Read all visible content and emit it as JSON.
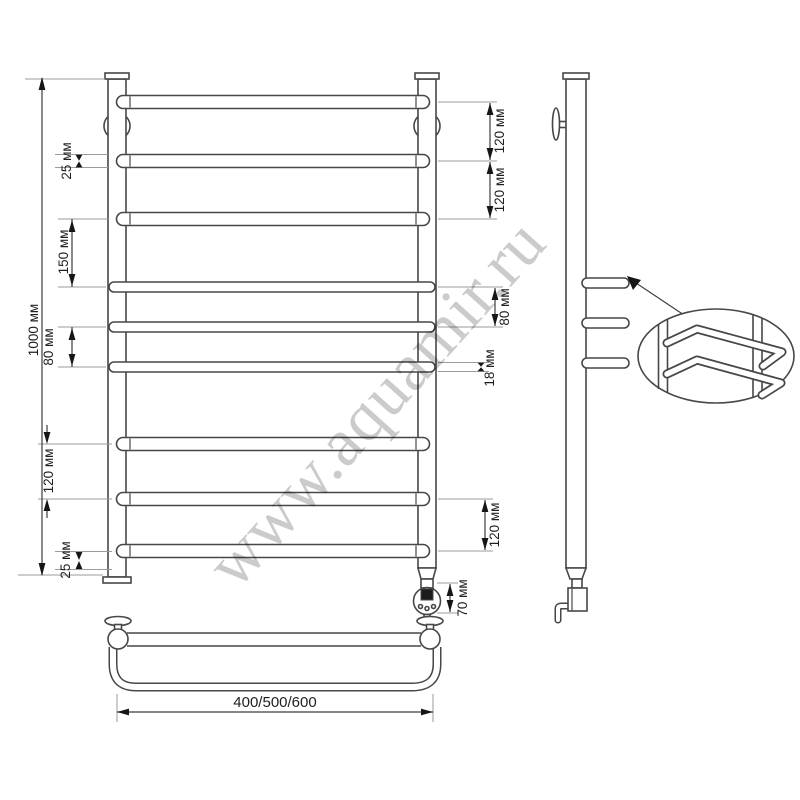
{
  "watermark": {
    "text": "www.aquamir.ru"
  },
  "dims": {
    "total_height": "1000 мм",
    "rail_diameter_25_top": "25 мм",
    "gap_150": "150 мм",
    "gap_80_left": "80 мм",
    "gap_120_left": "120 мм",
    "bottom_offset_25": "25 мм",
    "gap_120_right_1": "120 мм",
    "gap_120_right_2": "120 мм",
    "gap_80_right": "80 мм",
    "rail_diameter_18": "18 мм",
    "gap_120_right_3": "120 мм",
    "heater_70": "70 мм",
    "width_options": "400/500/600"
  }
}
